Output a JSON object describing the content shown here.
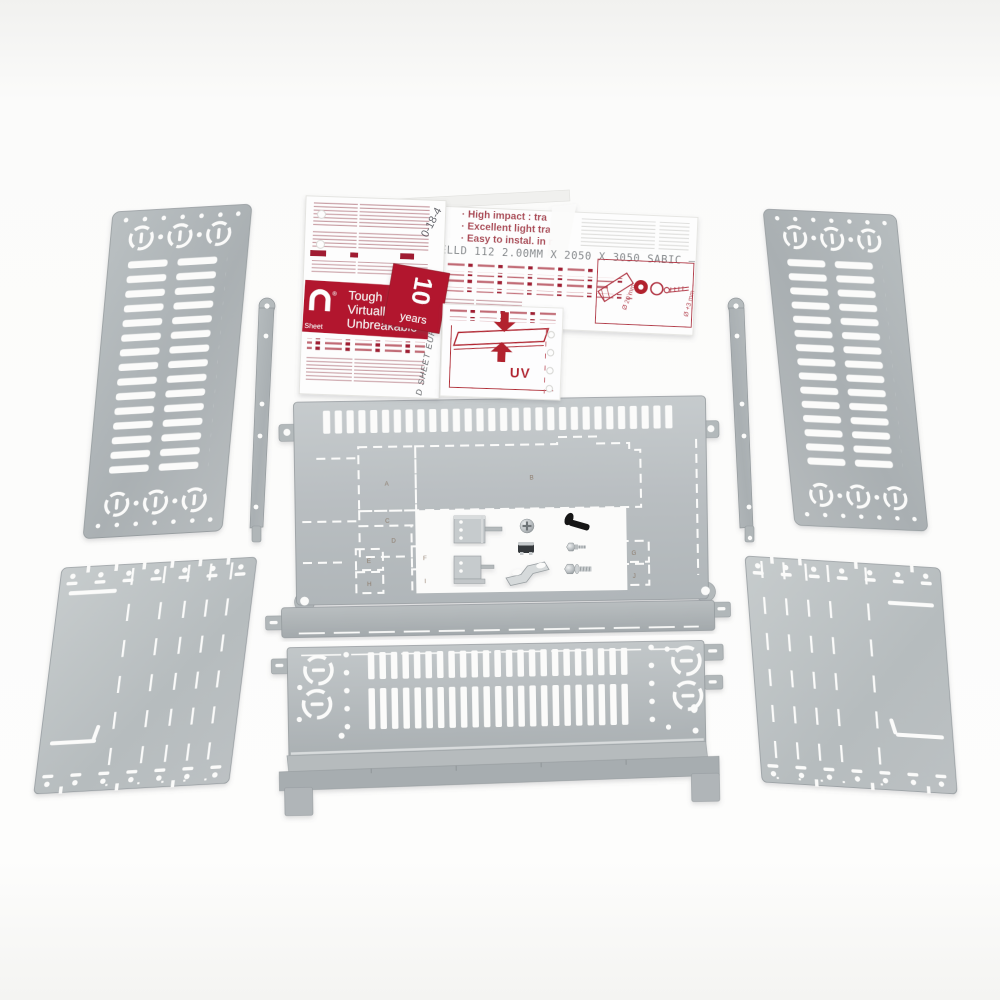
{
  "film": {
    "bullets": [
      "· High impact : tra",
      "· Excellent light tra",
      "· Easy to instal. in r"
    ],
    "code_line": "2944 EXELLD 112 2.00MM X 2050 X 3050 SABIC —",
    "banner": {
      "reg_mark": "®",
      "sub": "Sheet",
      "title_lines": [
        "Tough",
        "Virtually",
        "Unbreakable"
      ]
    },
    "years_badge": {
      "number": "10",
      "word": "years"
    },
    "uv_label": "UV",
    "diagram": {
      "hole_label": "Ø 20 mm",
      "screw_label": "Ø +3 mm"
    },
    "handwritten_mark": "0-18-4",
    "edge_text": "D SHEET EURO"
  },
  "panels": {
    "knockout_labels": [
      "A",
      "B",
      "C",
      "D",
      "E",
      "F",
      "G",
      "H",
      "I",
      "J"
    ],
    "top_slot_count": 30,
    "bottom_slot_columns": 23,
    "side_panel_slot_rows": 15
  },
  "colors": {
    "metal": "#bcc1c4",
    "metal_dark": "#a7adb0",
    "print_red": "#b01a30",
    "print_gray": "#72767a",
    "background": "#fbfbfa"
  }
}
